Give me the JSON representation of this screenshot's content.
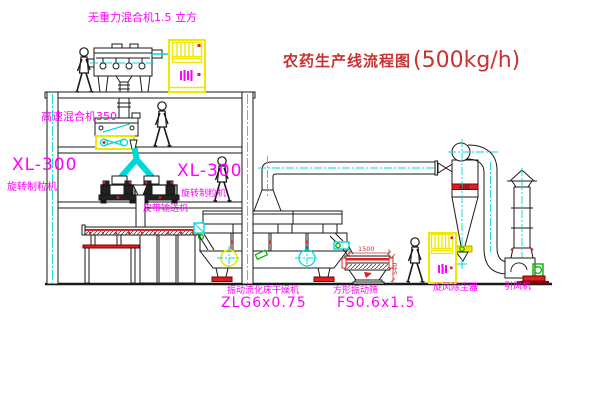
{
  "title": {
    "text": "农药生产线流程图",
    "capacity": "(500kg/h)",
    "color": "#c83232"
  },
  "labels": {
    "mixer1": "无重力混合机1.5 立方",
    "mixer2": "高速混合机350",
    "granulator_left_model": "XL-300",
    "granulator_left_name": "旋转制粒机",
    "granulator_right_model": "XL-300",
    "granulator_right_name": "旋转制粒机",
    "belt_conveyor": "皮带输送机",
    "dryer_name": "振动流化床干燥机",
    "dryer_model": "ZLG6x0.75",
    "sieve_name": "方形振动筛",
    "sieve_model": "FS0.6x1.5",
    "cyclone": "旋风除尘器",
    "fan": "引风机"
  },
  "dimensions": {
    "sieve_length": "1500",
    "sieve_height": "540",
    "cyclone_band": "400"
  },
  "colors": {
    "label_magenta": "#ff00ff",
    "line_black": "#1a1a1a",
    "centerline_cyan": "#00d8d8",
    "highlight_yellow": "#f0e800",
    "accent_red": "#e02020",
    "valve_green": "#00b400",
    "title_red": "#c83232"
  }
}
